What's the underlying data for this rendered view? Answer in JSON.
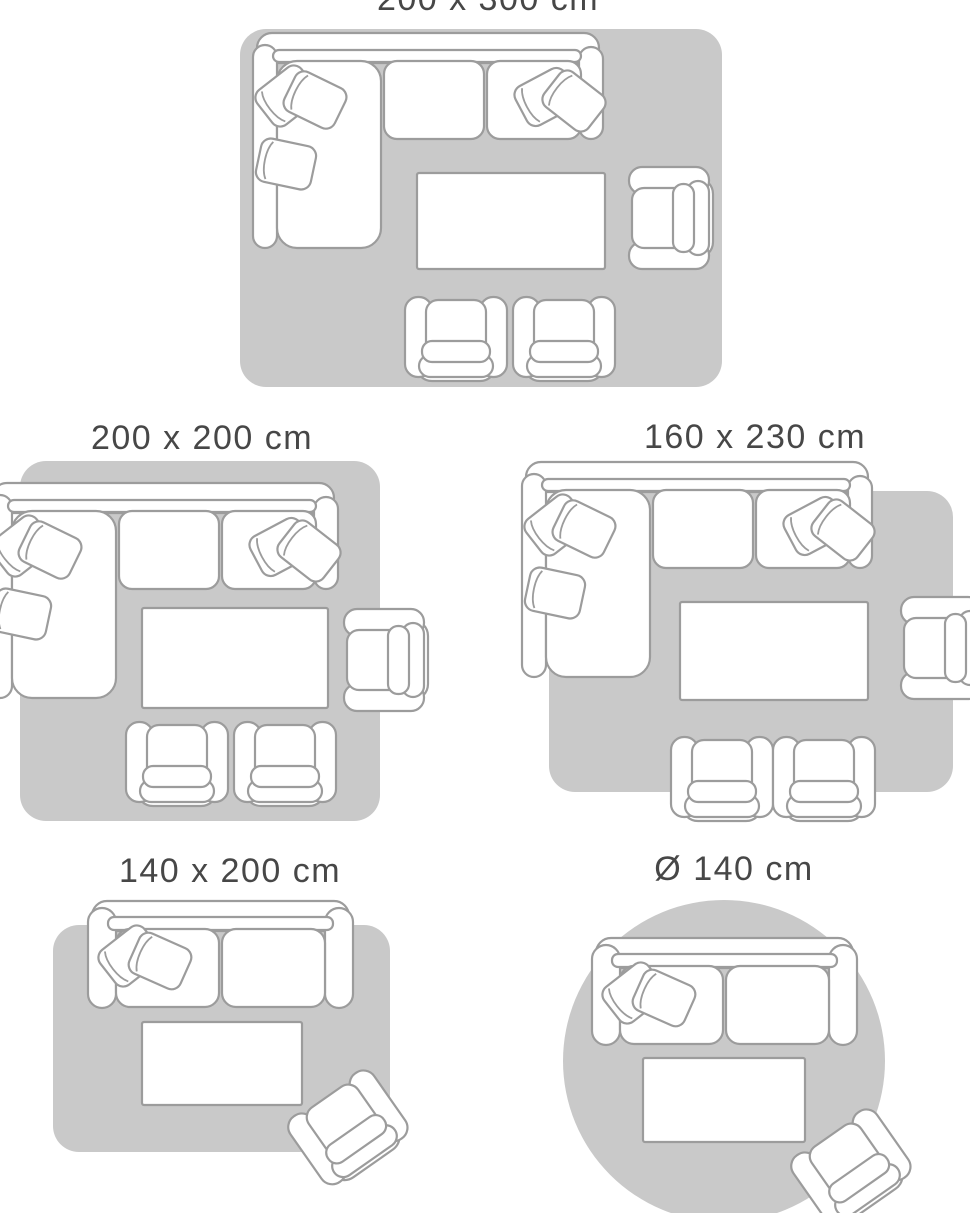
{
  "theme": {
    "background": "#FFFFFF",
    "rug_color": "#C9C9C9",
    "furniture_fill": "#FFFFFF",
    "furniture_outline": "#9C9C9C",
    "label_color": "#474747"
  },
  "guide": {
    "panels": [
      {
        "id": "200x300",
        "label": "200 x 300 cm",
        "rug_shape": "rectangle",
        "furniture": [
          "corner-sofa",
          "coffee-table",
          "armchair",
          "armchair",
          "armchair"
        ]
      },
      {
        "id": "200x200",
        "label": "200 x 200 cm",
        "rug_shape": "rectangle",
        "furniture": [
          "corner-sofa",
          "coffee-table",
          "armchair",
          "armchair",
          "armchair"
        ]
      },
      {
        "id": "160x230",
        "label": "160 x 230 cm",
        "rug_shape": "rectangle",
        "furniture": [
          "corner-sofa",
          "coffee-table",
          "armchair",
          "armchair",
          "armchair"
        ]
      },
      {
        "id": "140x200",
        "label": "140 x 200 cm",
        "rug_shape": "rectangle",
        "furniture": [
          "loveseat-sofa",
          "coffee-table",
          "armchair"
        ]
      },
      {
        "id": "diameter-140",
        "label": "Ø 140 cm",
        "rug_shape": "circle",
        "furniture": [
          "loveseat-sofa",
          "coffee-table",
          "armchair"
        ]
      }
    ]
  }
}
